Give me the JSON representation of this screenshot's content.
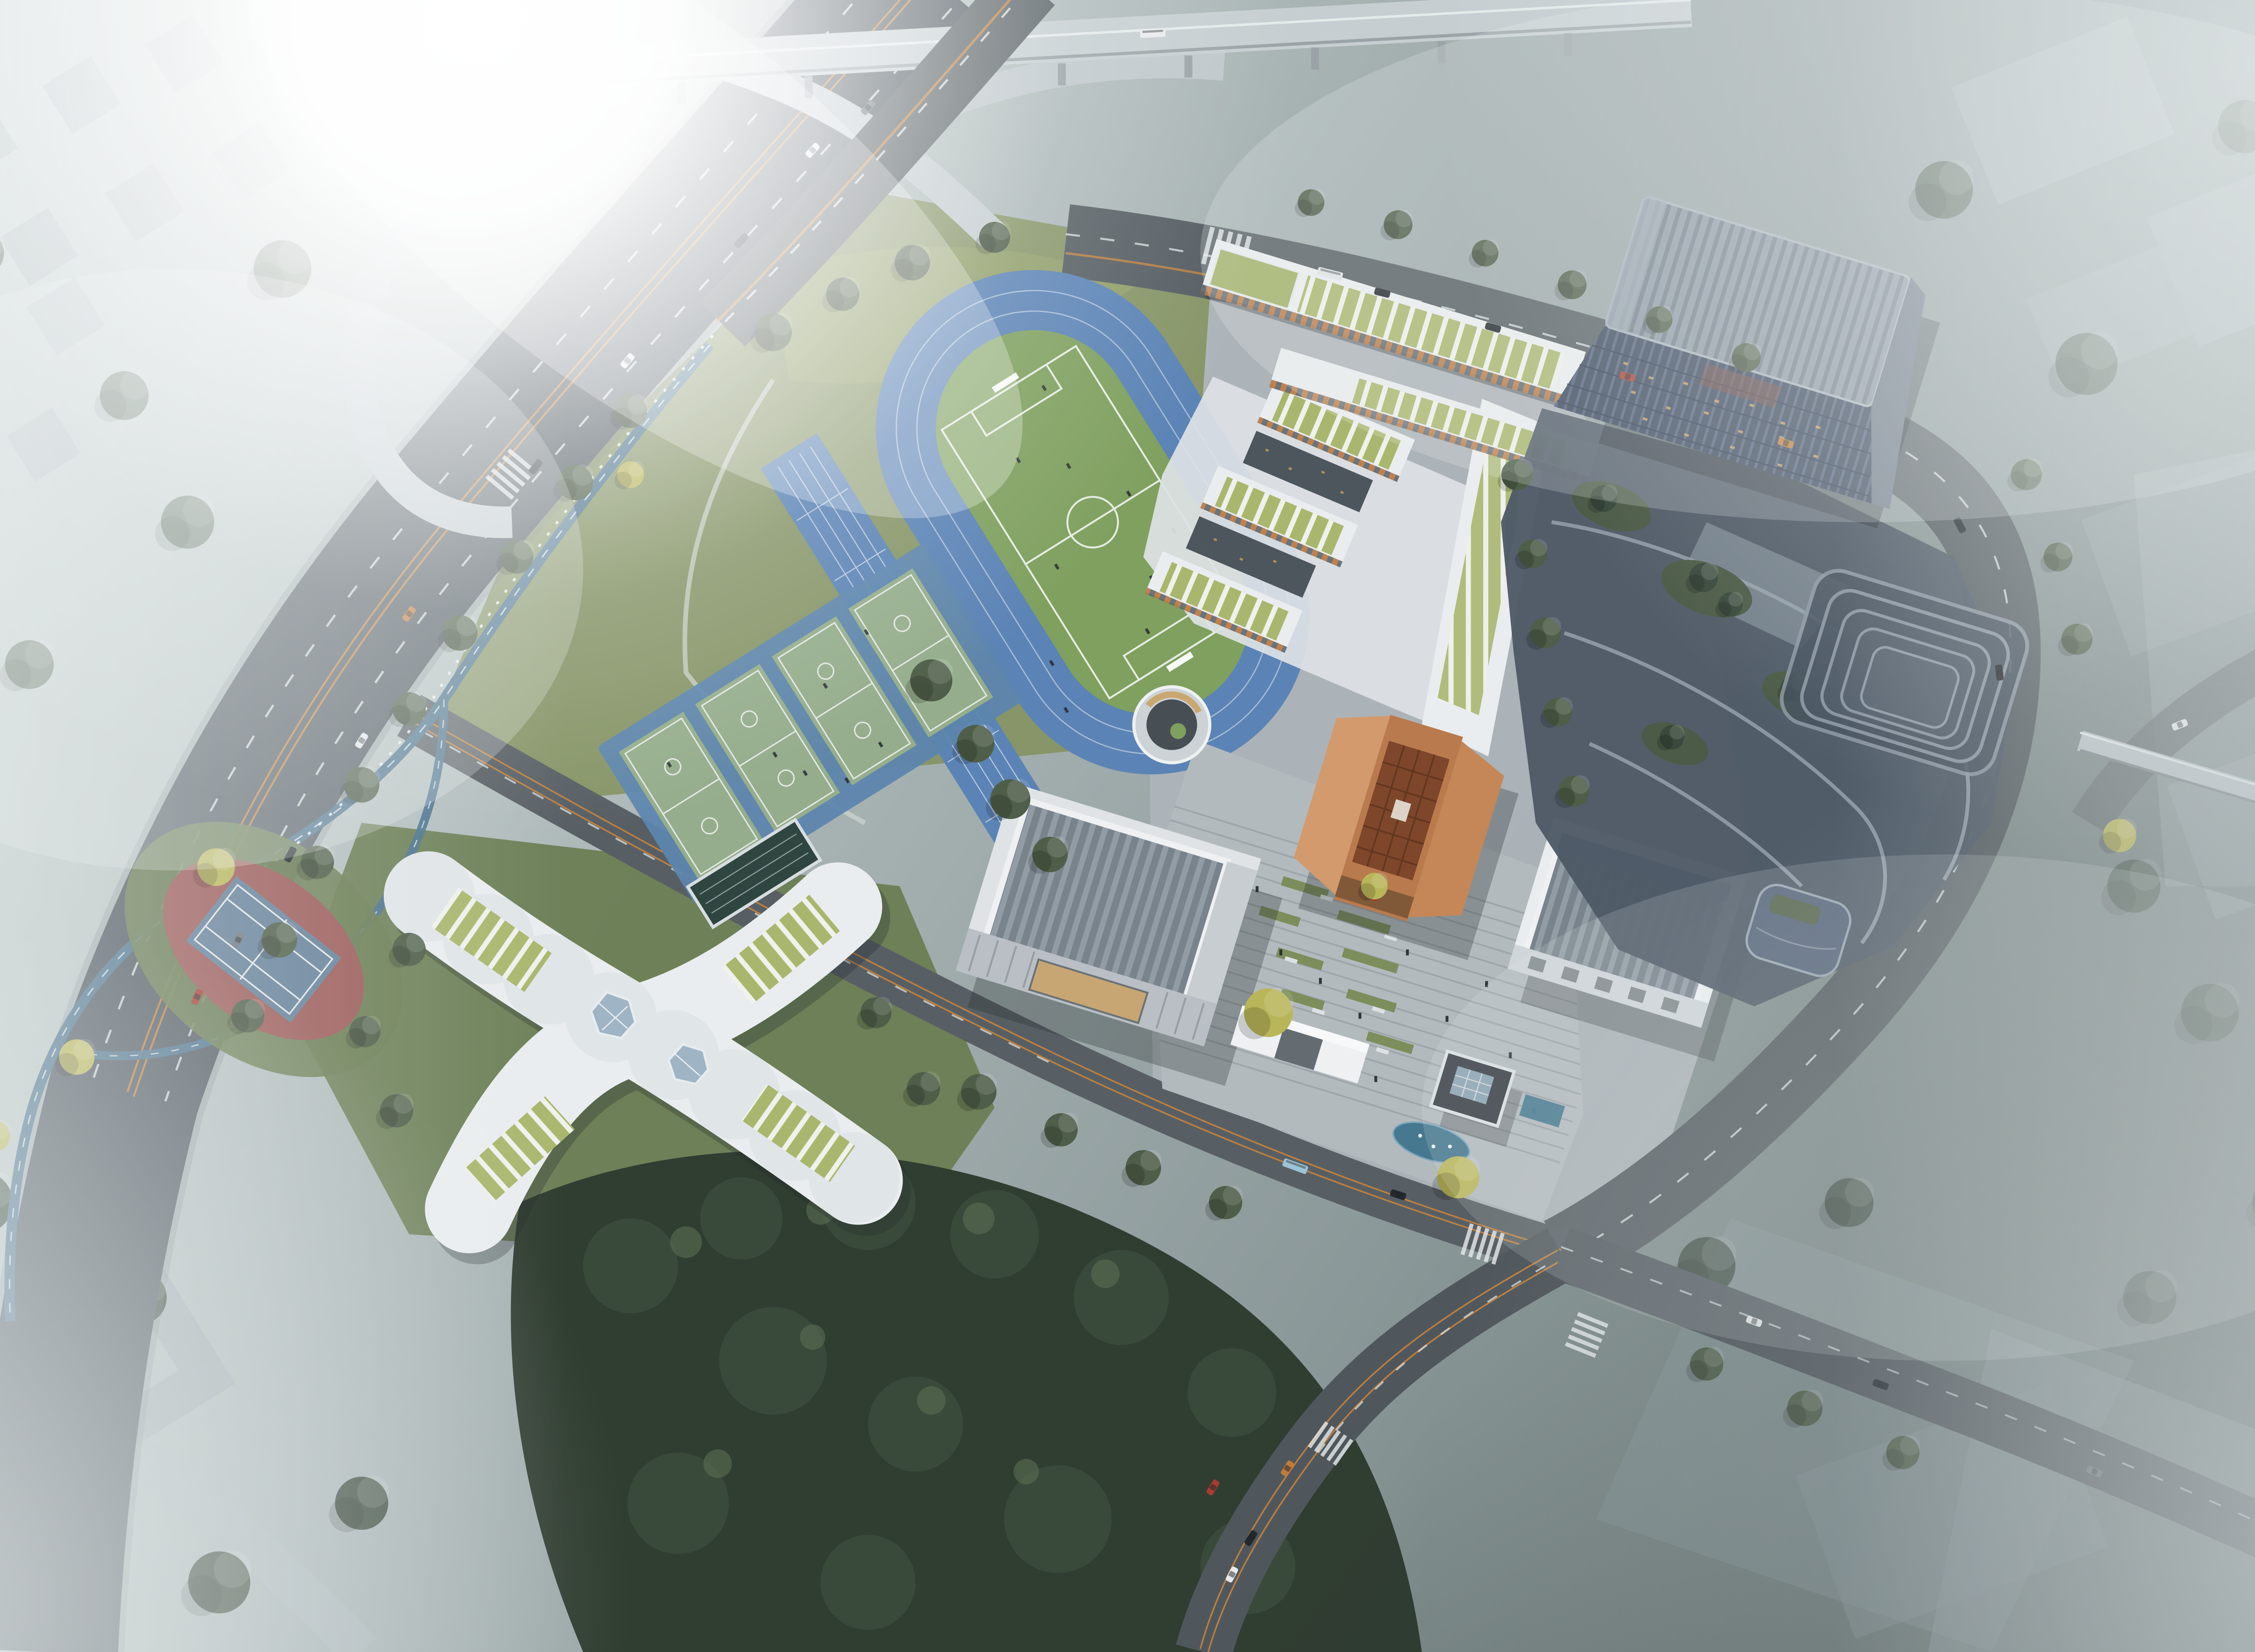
{
  "scene": {
    "domain": "architectural-aerial-rendering",
    "title": "Foggy aerial rendering of a school campus beside a highway interchange",
    "view": "bird's-eye oblique",
    "lighting": "strong sun glare from upper-left, morning haze and fog banks at the edges",
    "legible_text": "none"
  },
  "palette": {
    "fog_white": "#f2f5f5",
    "haze_light": "#d7dede",
    "haze_mid": "#aeb9b9",
    "haze_dark": "#5a6867",
    "road_dark": "#4d5559",
    "road_mid": "#5c6468",
    "ramp_light": "#c2cacd",
    "lane_white": "#dfe5e7",
    "median_orange": "#c8833c",
    "lawn_green": "#879568",
    "lawn_bright": "#9aa869",
    "park_green": "#6a7d53",
    "forest_dark": "#303d31",
    "tree_green": "#4e5e48",
    "ginkgo_yellow": "#b9b65a",
    "track_blue": "#5b83b5",
    "field_green": "#7fa05f",
    "court_green": "#95ad8c",
    "court_blue": "#5d85ae",
    "tennis_red": "#9b5a58",
    "tennis_blue": "#647f98",
    "path_blue": "#4d748f",
    "white_building": "#e9edef",
    "roof_green": "#a9b76e",
    "facade_dark": "#525b60",
    "orange_accent": "#b9763f",
    "copper_main": "#b97a4e",
    "copper_light": "#d39a6d",
    "copper_roof": "#7e462a",
    "glass_dark": "#3d495a",
    "tower_frame": "#8b97a2",
    "podium_dark": "#4e5a66",
    "podium_edge": "#9aa5b0",
    "warm_light": "#c9a05e",
    "pond_blue": "#46788f",
    "paving_light": "#b3babe",
    "paving_stripe": "#99a1a7",
    "gate_white": "#eef0f2",
    "ghost_block": "#9aa6ac"
  },
  "features": {
    "sports": {
      "running_track_lanes": 6,
      "infield": "soccer field with two goals and white markings",
      "straight_sprint_track": 1,
      "basketball_courts": 4,
      "tennis_courts": 1,
      "covered_court_canopy": 1
    },
    "buildings": {
      "classroom_wings": 3,
      "north_classroom_building": "white frame, green pergola roof, orange window slots",
      "assembly_hall": "white volume with grey ribbed skylight roof and colonnade",
      "copper_building": "square block with carved copper lattice roof and small red seal",
      "gymnasium": "white volume with grey panel roof and skylight strip",
      "x_shaped_building": "four curved wings, striped green roofs, two polygonal skylights",
      "sunken_circular_courtyard": 1,
      "entrance_gate": "white portal frame on plaza edge",
      "pond_pavilion": "dark pavilion with gridded glass roof beside fountain pond",
      "glass_tower": "tilted dark glass high-rise with lit interiors",
      "terraced_podium": "stepped cascade of roof gardens and trees",
      "sky_bridge": "pedestrian bridge crossing the east road"
    },
    "landscape": {
      "cycle_path": "blue winding lane with white edge line",
      "ginkgo_trees": "yellow accent trees on plaza and roadside",
      "dense_forest": "dark tree mass south of campus",
      "fog_banks": [
        "left",
        "top-right",
        "right",
        "bottom-left",
        "bottom-right"
      ]
    },
    "traffic": {
      "median": "double orange line",
      "interchange_ramps": 3,
      "elevated_viaduct": 1,
      "crosswalks": 5,
      "cars": 26,
      "buses": 3
    }
  }
}
